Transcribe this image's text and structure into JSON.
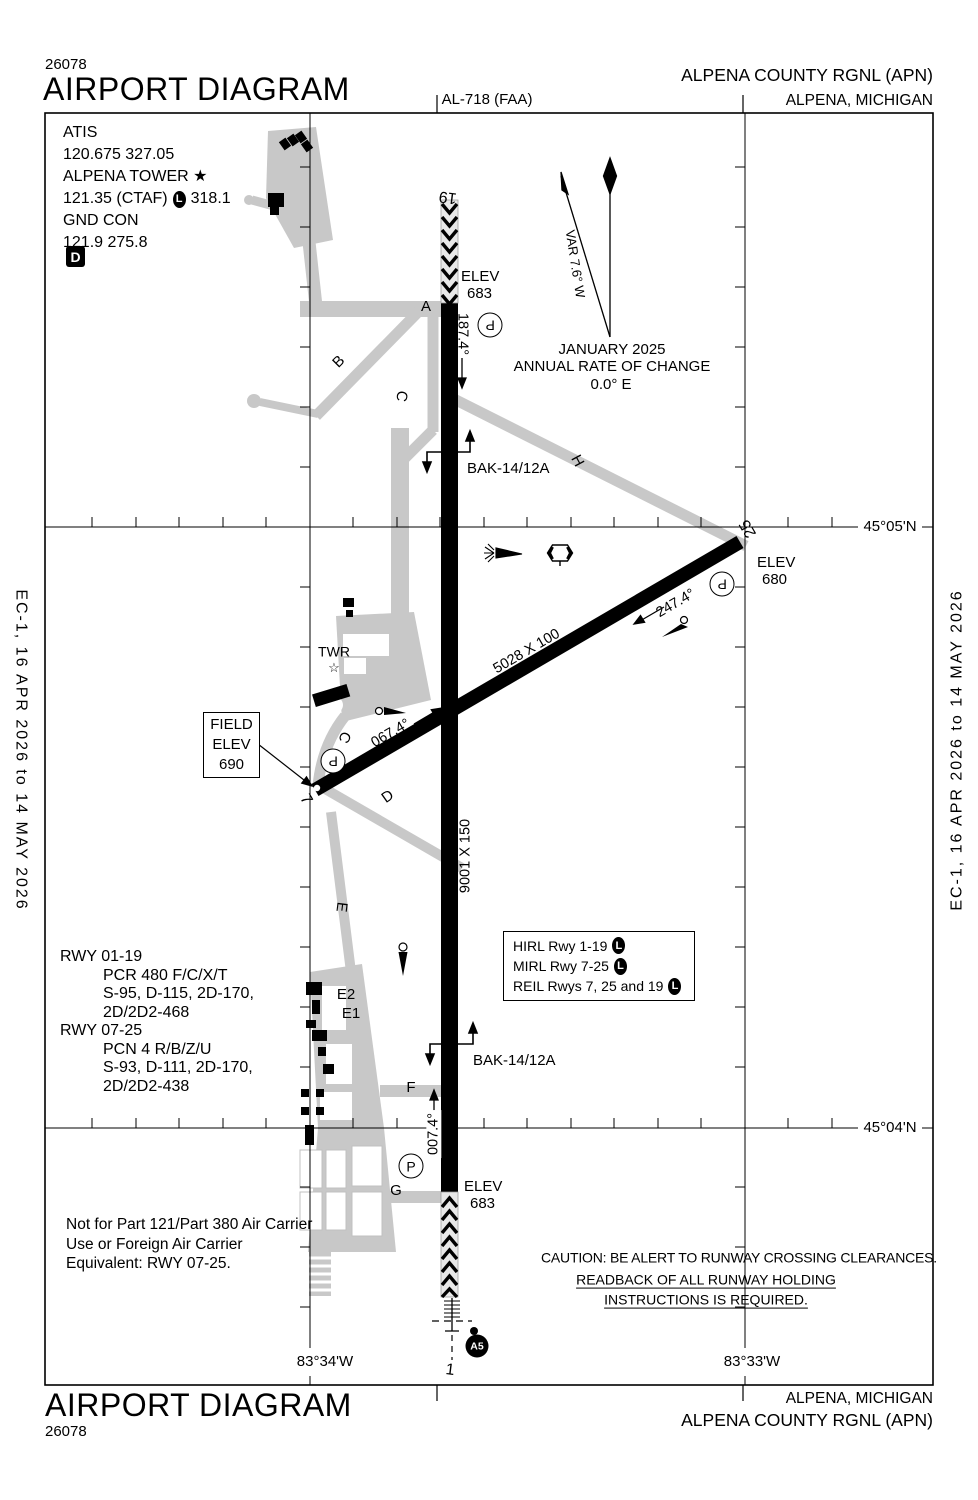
{
  "header": {
    "chart_code_top": "26078",
    "title_top": "AIRPORT DIAGRAM",
    "chart_ref": "AL-718 (FAA)",
    "airport_line_top": "ALPENA COUNTY RGNL (APN)",
    "city_line_top": "ALPENA, MICHIGAN"
  },
  "footer": {
    "title_bottom": "AIRPORT DIAGRAM",
    "chart_code_bottom": "26078",
    "city_line_bottom": "ALPENA, MICHIGAN",
    "airport_line_bottom": "ALPENA COUNTY RGNL (APN)"
  },
  "side_margins": {
    "left_text": "EC-1, 16 APR 2026 to 14 MAY 2026",
    "right_text": "EC-1, 16 APR 2026 to 14 MAY 2026"
  },
  "frequencies": {
    "atis_label": "ATIS",
    "atis_values": "120.675  327.05",
    "tower_label": "ALPENA TOWER",
    "tower_star": "★",
    "tower_values": "121.35 (CTAF)",
    "pcl_symbol": "L",
    "tower_value2": "318.1",
    "gnd_label": "GND CON",
    "gnd_values": "121.9  275.8",
    "datis_symbol": "D"
  },
  "magnetic": {
    "variation": "VAR 7.6° W",
    "date": "JANUARY 2025",
    "change_label": "ANNUAL RATE OF CHANGE",
    "change_value": "0.0° E"
  },
  "graticule": {
    "lat_north": "45°05'N",
    "lat_south": "45°04'N",
    "lon_west": "83°34'W",
    "lon_east": "83°33'W"
  },
  "field_elevation": {
    "label1": "FIELD",
    "label2": "ELEV",
    "value": "690"
  },
  "tower": {
    "label": "TWR",
    "star": "☆"
  },
  "runway_01_19": {
    "end_19": "19",
    "end_1": "1",
    "dimensions": "9001 X 150",
    "heading_south": "187.4°",
    "heading_north": "007.4°",
    "elev_19_label": "ELEV",
    "elev_19_value": "683",
    "elev_1_label": "ELEV",
    "elev_1_value": "683"
  },
  "runway_07_25": {
    "end_7": "7",
    "end_25": "25",
    "dimensions": "5028 X 100",
    "heading_west": "247.4°",
    "heading_east": "067.4°",
    "elev_25_label": "ELEV",
    "elev_25_value": "680"
  },
  "arresting_gear": {
    "north": "BAK-14/12A",
    "south": "BAK-14/12A"
  },
  "taxiways": {
    "a": "A",
    "b": "B",
    "c_north": "C",
    "c_south": "C",
    "d": "D",
    "e": "E",
    "e1": "E1",
    "e2": "E2",
    "f": "F",
    "g": "G",
    "h": "H"
  },
  "hold_markers": {
    "p1": "P",
    "p2": "P",
    "p3": "P",
    "p4": "P"
  },
  "approach_lights": {
    "id": "A5"
  },
  "lighting_box": {
    "line1": "HIRL Rwy 1-19",
    "line2": "MIRL Rwy 7-25",
    "line3": "REIL Rwys 7, 25 and 19",
    "pcl_symbol": "L"
  },
  "runway_data": {
    "rwy1_title": "RWY 01-19",
    "rwy1_line1": "PCR 480 F/C/X/T",
    "rwy1_line2": "S-95, D-115, 2D-170,",
    "rwy1_line3": "2D/2D2-468",
    "rwy2_title": "RWY 07-25",
    "rwy2_line1": "PCN 4 R/B/Z/U",
    "rwy2_line2": "S-93, D-111, 2D-170,",
    "rwy2_line3": "2D/2D2-438"
  },
  "notes": {
    "carrier_line1": "Not for Part 121/Part 380 Air Carrier",
    "carrier_line2": "Use or Foreign Air Carrier",
    "carrier_line3": "Equivalent: RWY 07-25.",
    "caution_line1": "CAUTION: BE ALERT TO RUNWAY CROSSING CLEARANCES.",
    "caution_line2": "READBACK OF ALL RUNWAY HOLDING",
    "caution_line3": "INSTRUCTIONS IS REQUIRED."
  },
  "colors": {
    "taxiway_gray": "#c8c8c8",
    "ink": "#000000"
  }
}
